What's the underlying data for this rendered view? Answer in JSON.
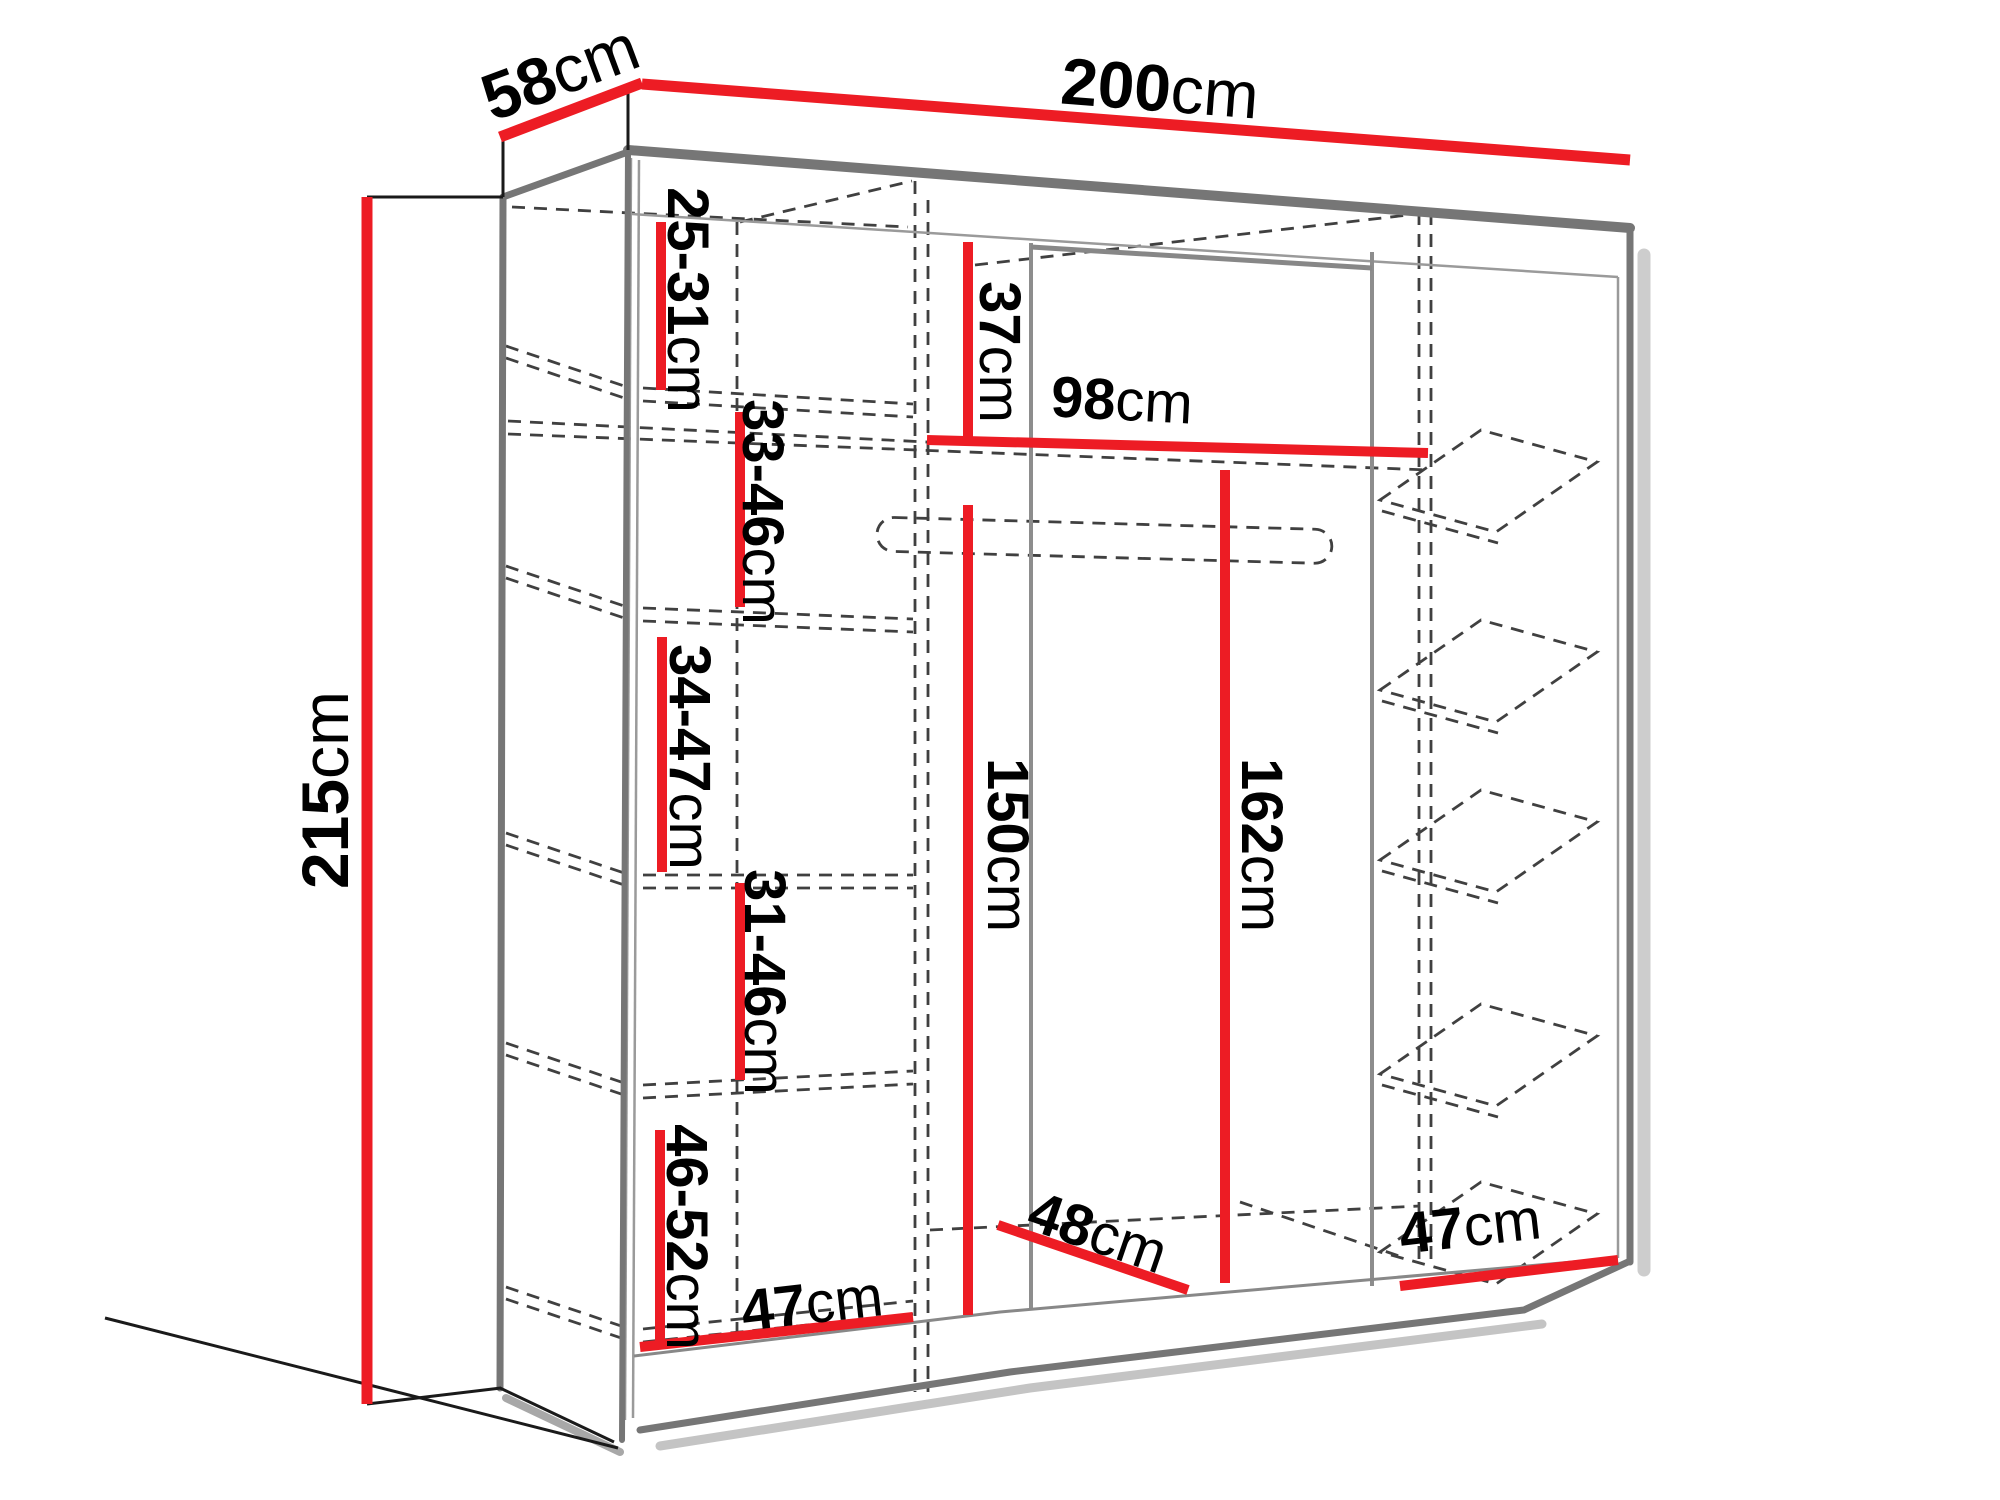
{
  "unit": "cm",
  "dimensions": {
    "width": "200",
    "depth": "58",
    "height": "215",
    "left_shelf_1": "25-31",
    "left_shelf_2": "33-46",
    "left_shelf_3": "34-47",
    "left_shelf_4": "31-46",
    "left_shelf_5": "46-52",
    "middle_top_height": "37",
    "middle_shelf_width": "98",
    "middle_hang_height": "150",
    "right_hang_height": "162",
    "middle_floor_depth": "48",
    "left_floor_width": "47",
    "right_floor_width": "47"
  },
  "colors": {
    "dimension_line": "#ed1c24",
    "edge_gray": "#767676",
    "dashed_gray": "#404040",
    "text": "#000000",
    "background": "#ffffff"
  }
}
